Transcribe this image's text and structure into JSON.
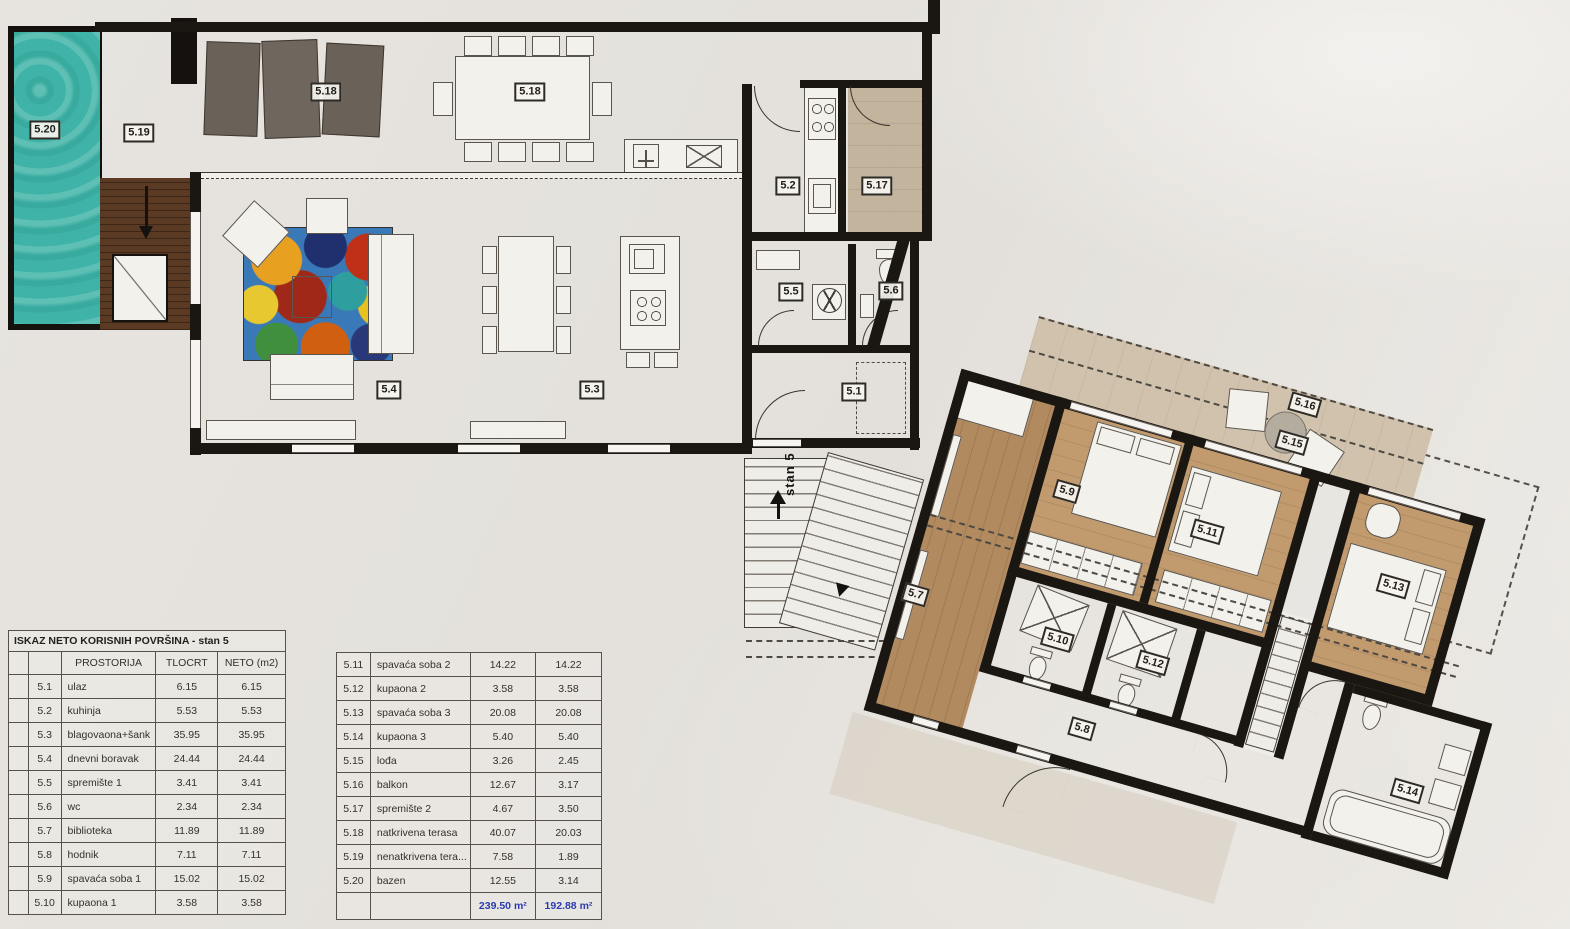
{
  "tables": {
    "left": {
      "title": "ISKAZ NETO KORISNIH POVRŠINA - stan 5",
      "headers": [
        "",
        "",
        "PROSTORIJA",
        "TLOCRT",
        "NETO (m2)"
      ],
      "rows": [
        [
          "",
          "5.1",
          "ulaz",
          "6.15",
          "6.15"
        ],
        [
          "",
          "5.2",
          "kuhinja",
          "5.53",
          "5.53"
        ],
        [
          "",
          "5.3",
          "blagovaona+šank",
          "35.95",
          "35.95"
        ],
        [
          "",
          "5.4",
          "dnevni boravak",
          "24.44",
          "24.44"
        ],
        [
          "",
          "5.5",
          "spremište 1",
          "3.41",
          "3.41"
        ],
        [
          "",
          "5.6",
          "wc",
          "2.34",
          "2.34"
        ],
        [
          "",
          "5.7",
          "biblioteka",
          "11.89",
          "11.89"
        ],
        [
          "",
          "5.8",
          "hodnik",
          "7.11",
          "7.11"
        ],
        [
          "",
          "5.9",
          "spavaća soba 1",
          "15.02",
          "15.02"
        ],
        [
          "",
          "5.10",
          "kupaona 1",
          "3.58",
          "3.58"
        ]
      ]
    },
    "right": {
      "rows": [
        [
          "5.11",
          "spavaća soba 2",
          "14.22",
          "14.22"
        ],
        [
          "5.12",
          "kupaona 2",
          "3.58",
          "3.58"
        ],
        [
          "5.13",
          "spavaća soba 3",
          "20.08",
          "20.08"
        ],
        [
          "5.14",
          "kupaona 3",
          "5.40",
          "5.40"
        ],
        [
          "5.15",
          "lođa",
          "3.26",
          "2.45"
        ],
        [
          "5.16",
          "balkon",
          "12.67",
          "3.17"
        ],
        [
          "5.17",
          "spremište 2",
          "4.67",
          "3.50"
        ],
        [
          "5.18",
          "natkrivena terasa",
          "40.07",
          "20.03"
        ],
        [
          "5.19",
          "nenatkrivena tera...",
          "7.58",
          "1.89"
        ],
        [
          "5.20",
          "bazen",
          "12.55",
          "3.14"
        ]
      ],
      "totals": {
        "tlocrt": "239.50 m²",
        "neto": "192.88 m²"
      }
    }
  },
  "plan": {
    "stairs_label": "stan 5",
    "labels_main": [
      {
        "id": "5.20",
        "x": 45,
        "y": 130
      },
      {
        "id": "5.19",
        "x": 139,
        "y": 133
      },
      {
        "id": "5.18",
        "x": 326,
        "y": 92
      },
      {
        "id": "5.18",
        "x": 530,
        "y": 92
      },
      {
        "id": "5.2",
        "x": 788,
        "y": 186
      },
      {
        "id": "5.17",
        "x": 877,
        "y": 186
      },
      {
        "id": "5.5",
        "x": 791,
        "y": 292
      },
      {
        "id": "5.6",
        "x": 891,
        "y": 291
      },
      {
        "id": "5.4",
        "x": 389,
        "y": 390
      },
      {
        "id": "5.3",
        "x": 592,
        "y": 390
      },
      {
        "id": "5.1",
        "x": 854,
        "y": 392
      }
    ],
    "labels_wing": [
      {
        "id": "5.16",
        "x": 430,
        "y": 45
      },
      {
        "id": "5.15",
        "x": 428,
        "y": 85
      },
      {
        "id": "5.9",
        "x": 225,
        "y": 194
      },
      {
        "id": "5.11",
        "x": 371,
        "y": 194
      },
      {
        "id": "5.13",
        "x": 565,
        "y": 195
      },
      {
        "id": "5.10",
        "x": 257,
        "y": 339
      },
      {
        "id": "5.12",
        "x": 355,
        "y": 335
      },
      {
        "id": "5.8",
        "x": 305,
        "y": 418
      },
      {
        "id": "5.14",
        "x": 635,
        "y": 388
      },
      {
        "id": "5.7",
        "x": 108,
        "y": 335
      }
    ],
    "colors": {
      "pool": "#3fb3a7",
      "deck": "#553620",
      "terrace": "#c9bba9",
      "living_wood": "#a8815b",
      "tile": "#c2bab0",
      "wing_wood": "#c19a6e",
      "bath": "#a59d94",
      "balcony": "#d0c2ac",
      "wall": "#1a1713",
      "totals_blue": "#2c3cae"
    }
  }
}
